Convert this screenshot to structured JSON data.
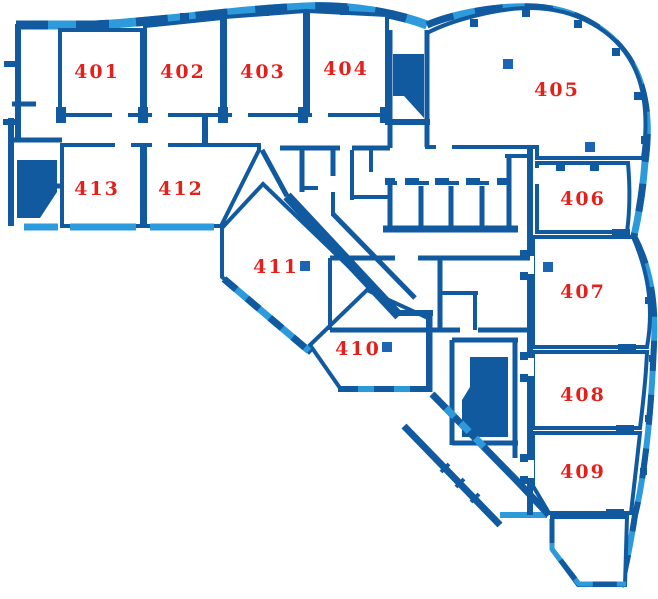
{
  "plan": {
    "floor_prefix": "4",
    "rooms": [
      {
        "number": "401",
        "cx": 97,
        "cy": 78
      },
      {
        "number": "402",
        "cx": 183,
        "cy": 78
      },
      {
        "number": "403",
        "cx": 263,
        "cy": 78
      },
      {
        "number": "404",
        "cx": 346,
        "cy": 75
      },
      {
        "number": "405",
        "cx": 557,
        "cy": 96
      },
      {
        "number": "406",
        "cx": 583,
        "cy": 205
      },
      {
        "number": "407",
        "cx": 583,
        "cy": 298
      },
      {
        "number": "408",
        "cx": 583,
        "cy": 401
      },
      {
        "number": "409",
        "cx": 583,
        "cy": 478
      },
      {
        "number": "410",
        "cx": 358,
        "cy": 355
      },
      {
        "number": "411",
        "cx": 276,
        "cy": 273
      },
      {
        "number": "412",
        "cx": 181,
        "cy": 195
      },
      {
        "number": "413",
        "cx": 97,
        "cy": 195
      }
    ],
    "columns": [
      {
        "x": 508,
        "y": 64
      },
      {
        "x": 590,
        "y": 147
      },
      {
        "x": 548,
        "y": 267
      },
      {
        "x": 305,
        "y": 266
      },
      {
        "x": 387,
        "y": 347
      }
    ]
  },
  "colors": {
    "wall": "#125A9F",
    "glazing": "#2D9BDB",
    "label": "#E3211C",
    "column": "#1E64B4",
    "room_fill": "#FFFFFF",
    "background": "#FFFFFF"
  }
}
